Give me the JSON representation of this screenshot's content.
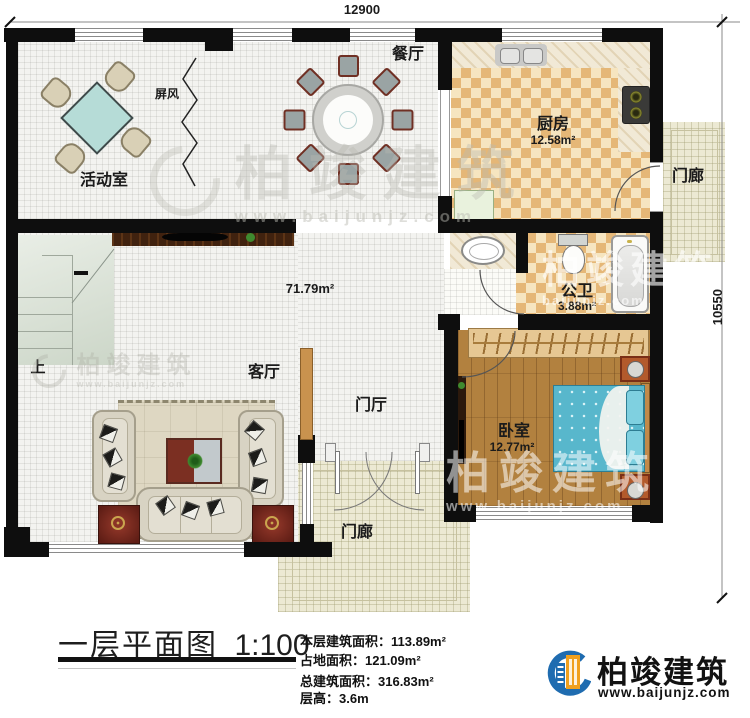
{
  "plan": {
    "dimension_top": "12900",
    "dimension_right": "10550",
    "rooms": {
      "activity": {
        "label": "活动室"
      },
      "screen": {
        "label": "屏风"
      },
      "dining": {
        "label": "餐厅"
      },
      "kitchen": {
        "label": "厨房",
        "area": "12.58m²"
      },
      "porch_right": {
        "label": "门廊"
      },
      "bathroom": {
        "label": "公卫",
        "area": "3.88m²"
      },
      "bedroom": {
        "label": "卧室",
        "area": "12.77m²"
      },
      "living": {
        "label": "客厅"
      },
      "hall": {
        "label": "门厅"
      },
      "porch_bottom": {
        "label": "门廊"
      },
      "stairs": {
        "label": "上"
      },
      "open_area": {
        "area": "71.79m²"
      }
    }
  },
  "title_block": {
    "title": "一层平面图",
    "scale": "1:100",
    "stats": [
      "本层建筑面积：113.89m²",
      "占地面积：121.09m²",
      "总建筑面积：316.83m²",
      "层高：3.6m"
    ]
  },
  "branding": {
    "company": "柏竣建筑",
    "website": "www.baijunjz.com",
    "website_short": "baijunjz.com"
  },
  "colors": {
    "wall": "#0e0e0e",
    "checker_dark": "#e5b777",
    "wood": "#b2813f",
    "bed": "#58b7cc",
    "logo_blue": "#1f6cb0",
    "logo_orange": "#f0a01e"
  }
}
